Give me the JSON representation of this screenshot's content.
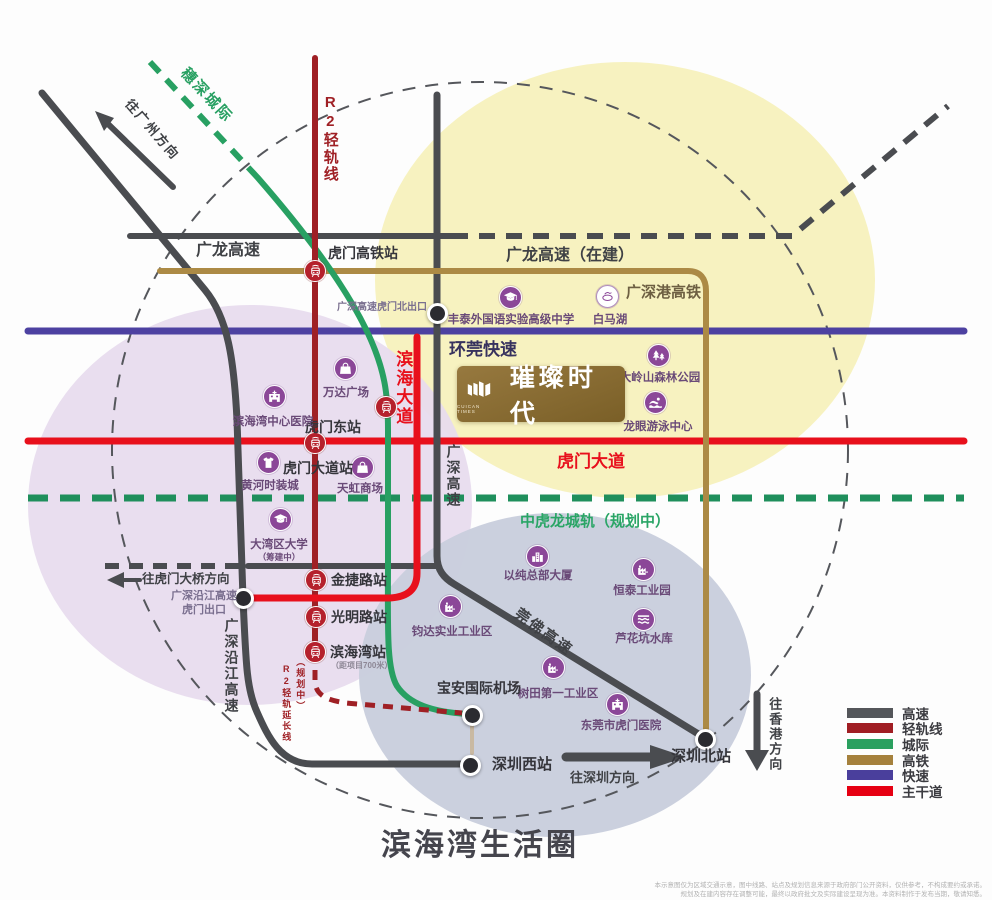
{
  "title": "滨海湾生活圈",
  "logo": {
    "name": "璀璨时代",
    "sub": "CUICAN TIMES"
  },
  "colors": {
    "gray": "#4a4c50",
    "ink": "#3f4145",
    "ink2": "#35353b",
    "red": "#e8101c",
    "red_dark": "#9f2025",
    "green": "#28a062",
    "green2": "#2aa566",
    "green_dark": "#1f8f5c",
    "brown": "#ac8a45",
    "purple": "#4d41a1",
    "tan": "#c9b9a2",
    "poi": "#8b4798",
    "station": "#b5212c",
    "poi_label": "#6a4a78",
    "node_label": "#7a6f8f",
    "sub": "#8d8795"
  },
  "zones": [
    {
      "id": "zone-yellow",
      "cx": 625,
      "cy": 280,
      "rx": 250,
      "ry": 218,
      "fill": "#f7f1bd",
      "opacity": 0.95
    },
    {
      "id": "zone-purple",
      "cx": 250,
      "cy": 505,
      "rx": 222,
      "ry": 200,
      "fill": "#e7dbee",
      "opacity": 0.93
    },
    {
      "id": "zone-blue",
      "cx": 555,
      "cy": 675,
      "rx": 196,
      "ry": 162,
      "fill": "#c9cedd",
      "opacity": 0.96
    }
  ],
  "boundary": {
    "cx": 480,
    "cy": 450,
    "r": 368,
    "color": "#55575c",
    "w": 2,
    "dash": "13 10"
  },
  "lines": [
    {
      "id": "huanguan-expressway",
      "color": "purple",
      "w": 7,
      "d": "M28 331H964"
    },
    {
      "id": "humen-avenue-road",
      "color": "red",
      "w": 7,
      "d": "M28 441H964"
    },
    {
      "id": "zhonghulong-rail",
      "color": "green_dark",
      "w": 7,
      "dash": "20 12",
      "d": "M28 498H964"
    },
    {
      "id": "guanglong-expwy",
      "color": "gray",
      "w": 6,
      "d": "M130 236H452"
    },
    {
      "id": "guanglong-expwy-uc",
      "color": "gray",
      "w": 6,
      "dash": "16 11",
      "d": "M452 236H792L948 106"
    },
    {
      "id": "yanjiang-expwy",
      "color": "gray",
      "w": 7,
      "d": "M42 93L205 290C228 318 234 360 237 420L243 598C246 668 247 690 257 712C268 737 281 764 312 764H470"
    },
    {
      "id": "humen-bridge-dashed",
      "color": "gray",
      "w": 6,
      "dash": "14 10",
      "d": "M105 566H248"
    },
    {
      "id": "humen-bridge-solid",
      "color": "gray",
      "w": 6,
      "d": "M248 566H437"
    },
    {
      "id": "guangshen-expwy",
      "color": "gray",
      "w": 7,
      "d": "M437 95V556C437 570 444 578 454 584L700 735"
    },
    {
      "id": "hsr-line",
      "color": "brown",
      "w": 6,
      "d": "M160 271H688C700 271 706 278 706 291V737"
    },
    {
      "id": "suishen-intercity-dashed",
      "color": "green",
      "w": 6,
      "dash": "14 10",
      "d": "M150 62L258 178"
    },
    {
      "id": "suishen-intercity",
      "color": "green",
      "w": 6,
      "d": "M258 178C312 240 356 300 375 350C385 376 388 396 388 430V560C388 625 386 668 397 686C409 704 432 712 468 714"
    },
    {
      "id": "r2-line",
      "color": "red_dark",
      "w": 6,
      "d": "M315 58V652"
    },
    {
      "id": "r2-extension",
      "color": "red_dark",
      "w": 5,
      "dash": "10 8",
      "d": "M315 652V680C315 695 326 700 346 703L462 713"
    },
    {
      "id": "binhai-avenue-road",
      "color": "red",
      "w": 7,
      "d": "M417 337V573C417 589 408 597 390 598H253"
    },
    {
      "id": "airport-link",
      "color": "tan",
      "w": 4,
      "d": "M472 717V753"
    },
    {
      "id": "arrow-guangzhou-shaft",
      "color": "gray",
      "w": 6,
      "d": "M173 187L106 122"
    },
    {
      "id": "arrow-humen-bridge-shaft",
      "color": "gray",
      "w": 4,
      "d": "M122 580H140"
    },
    {
      "id": "arrow-shenzhen-shaft",
      "color": "gray",
      "w": 9,
      "d": "M566 757H652"
    },
    {
      "id": "arrow-hongkong-shaft",
      "color": "gray",
      "w": 7,
      "d": "M757 694V751"
    }
  ],
  "arrow_heads": [
    {
      "id": "arrow-guangzhou-head",
      "pts": "95,111 114,118 104,131"
    },
    {
      "id": "arrow-humen-bridge-head",
      "pts": "107,580 124,572 124,588"
    },
    {
      "id": "arrow-shenzhen-head",
      "pts": "650,745 686,757 650,769"
    },
    {
      "id": "arrow-hongkong-head",
      "pts": "745,750 769,750 757,771"
    }
  ],
  "stations": [
    {
      "id": "humen-hsr-station",
      "x": 315,
      "y": 271,
      "label": "虎门高铁站",
      "lx": 328,
      "ly": 245
    },
    {
      "id": "humen-east-station",
      "x": 386,
      "y": 407,
      "label": "虎门东站",
      "lx": 305,
      "ly": 419
    },
    {
      "id": "humen-avenue-station",
      "x": 315,
      "y": 443,
      "label": "虎门大道站",
      "lx": 283,
      "ly": 460
    },
    {
      "id": "jinjie-road-station",
      "x": 316,
      "y": 580,
      "label": "金捷路站",
      "lx": 331,
      "ly": 572
    },
    {
      "id": "guangming-road-station",
      "x": 316,
      "y": 617,
      "label": "光明路站",
      "lx": 331,
      "ly": 609
    },
    {
      "id": "binhaiwan-station",
      "x": 315,
      "y": 652,
      "label": "滨海湾站",
      "lx": 330,
      "ly": 644,
      "sub": "（距项目700米）",
      "sx": 331,
      "sy": 661
    }
  ],
  "pois": [
    {
      "id": "fengtai-school",
      "x": 510,
      "y": 297,
      "icon": "cap",
      "label": "丰泰外国语实验高级中学",
      "lx": 511,
      "ly": 313
    },
    {
      "id": "baima-lake",
      "x": 607,
      "y": 296,
      "icon": "lake",
      "outline": true,
      "label": "白马湖",
      "lx": 610,
      "ly": 313
    },
    {
      "id": "dalingshan-forest-park",
      "x": 658,
      "y": 355,
      "icon": "tree",
      "label": "大岭山森林公园",
      "lx": 660,
      "ly": 371
    },
    {
      "id": "longyan-swim-center",
      "x": 655,
      "y": 402,
      "icon": "swim",
      "label": "龙眼游泳中心",
      "lx": 658,
      "ly": 420
    },
    {
      "id": "binhaiwan-hospital",
      "x": 274,
      "y": 396,
      "icon": "hospital",
      "label": "滨海湾中心医院",
      "lx": 273,
      "ly": 415
    },
    {
      "id": "wanda-plaza",
      "x": 345,
      "y": 368,
      "icon": "bag",
      "label": "万达广场",
      "lx": 346,
      "ly": 386
    },
    {
      "id": "huanghe-fashion-city",
      "x": 268,
      "y": 462,
      "icon": "clothes",
      "label": "黄河时装城",
      "lx": 270,
      "ly": 479
    },
    {
      "id": "tianhong-mall",
      "x": 362,
      "y": 467,
      "icon": "bag",
      "label": "天虹商场",
      "lx": 360,
      "ly": 482
    },
    {
      "id": "greater-bay-university",
      "x": 280,
      "y": 519,
      "icon": "cap",
      "label": "大湾区大学",
      "lx": 279,
      "ly": 538,
      "sub": "（筹建中）",
      "sx": 279,
      "sy": 552
    },
    {
      "id": "yichun-hq-tower",
      "x": 537,
      "y": 556,
      "icon": "building",
      "label": "以纯总部大厦",
      "lx": 538,
      "ly": 569
    },
    {
      "id": "hengtai-industrial-park",
      "x": 643,
      "y": 569,
      "icon": "factory",
      "label": "恒泰工业园",
      "lx": 642,
      "ly": 584
    },
    {
      "id": "luhuakeng-reservoir",
      "x": 643,
      "y": 619,
      "icon": "waves",
      "label": "芦花坑水库",
      "lx": 644,
      "ly": 632
    },
    {
      "id": "junda-industrial-zone",
      "x": 450,
      "y": 606,
      "icon": "factory",
      "label": "钧达实业工业区",
      "lx": 452,
      "ly": 625
    },
    {
      "id": "shutian-industrial-zone",
      "x": 553,
      "y": 667,
      "icon": "factory",
      "label": "树田第一工业区",
      "lx": 558,
      "ly": 687
    },
    {
      "id": "dongguan-humen-hospital",
      "x": 617,
      "y": 704,
      "icon": "hospital",
      "label": "东莞市虎门医院",
      "lx": 621,
      "ly": 719
    }
  ],
  "nodes": [
    {
      "id": "guangshen-humen-north-exit",
      "x": 437,
      "y": 313
    },
    {
      "id": "yanjiang-humen-exit",
      "x": 243,
      "y": 598
    },
    {
      "id": "baoan-airport",
      "x": 472,
      "y": 715
    },
    {
      "id": "shenzhen-west-station",
      "x": 470,
      "y": 765
    },
    {
      "id": "shenzhen-north-station",
      "x": 705,
      "y": 739
    }
  ],
  "labels": [
    {
      "id": "guanglong-label",
      "text": "广龙高速",
      "x": 196,
      "y": 241,
      "size": 16,
      "color": "ink",
      "mode": "left"
    },
    {
      "id": "guanglong-uc-label",
      "text": "广龙高速（在建）",
      "x": 506,
      "y": 246,
      "size": 16,
      "color": "ink",
      "mode": "left"
    },
    {
      "id": "r2-label",
      "text": "R2轻轨线",
      "x": 320,
      "y": 94,
      "size": 15,
      "color": "red_dark",
      "mode": "vert"
    },
    {
      "id": "suishen-label",
      "text": "穗深城际",
      "x": 206,
      "y": 96,
      "size": 15,
      "color": "green",
      "mode": "rot",
      "deg": 47
    },
    {
      "id": "gshk-hsr-label",
      "text": "广深港高铁",
      "x": 626,
      "y": 284,
      "size": 15,
      "color": "#6d5f42",
      "mode": "left"
    },
    {
      "id": "huanguan-label",
      "text": "环莞快速",
      "x": 449,
      "y": 339,
      "size": 17,
      "color": "#37325e",
      "mode": "left"
    },
    {
      "id": "humen-avenue-label",
      "text": "虎门大道",
      "x": 557,
      "y": 451,
      "size": 17,
      "color": "red",
      "mode": "left"
    },
    {
      "id": "binhai-avenue-label",
      "text": "滨海大道",
      "x": 392,
      "y": 350,
      "size": 17,
      "color": "red",
      "mode": "vert"
    },
    {
      "id": "guangshen-label",
      "text": "广深高速",
      "x": 444,
      "y": 444,
      "size": 14,
      "color": "ink",
      "mode": "vert"
    },
    {
      "id": "yanjiang-label",
      "text": "广深沿江高速",
      "x": 222,
      "y": 618,
      "size": 14,
      "color": "ink",
      "mode": "vert"
    },
    {
      "id": "wanfo-label",
      "text": "莞佛高速",
      "x": 543,
      "y": 633,
      "size": 15,
      "color": "ink",
      "mode": "rot",
      "deg": 36
    },
    {
      "id": "zhonghulong-label",
      "text": "中虎龙城轨（规划中）",
      "x": 520,
      "y": 513,
      "size": 15,
      "color": "green2",
      "mode": "left"
    },
    {
      "id": "r2-ext-label",
      "text": "R2轻轨延长线",
      "x": 280,
      "y": 664,
      "size": 9,
      "color": "red_dark",
      "mode": "vert"
    },
    {
      "id": "r2-ext-label-2",
      "text": "（规划中）",
      "x": 294,
      "y": 657,
      "size": 9,
      "color": "red_dark",
      "mode": "vert"
    },
    {
      "id": "north-exit-label",
      "text": "广深高速虎门北出口",
      "x": 427,
      "y": 302,
      "size": 10,
      "color": "node_label",
      "mode": "right"
    },
    {
      "id": "yanjiang-exit-label",
      "text": "广深沿江高速\n虎门出口",
      "x": 204,
      "y": 590,
      "size": 11,
      "color": "node_label",
      "mode": "center"
    },
    {
      "id": "baoan-airport-label",
      "text": "宝安国际机场",
      "x": 437,
      "y": 680,
      "size": 14,
      "color": "ink2",
      "mode": "left"
    },
    {
      "id": "shenzhen-west-label",
      "text": "深圳西站",
      "x": 492,
      "y": 756,
      "size": 15,
      "color": "ink2",
      "mode": "left"
    },
    {
      "id": "shenzhen-north-label",
      "text": "深圳北站",
      "x": 671,
      "y": 748,
      "size": 15,
      "color": "ink2",
      "mode": "left"
    },
    {
      "id": "to-guangzhou-label",
      "text": "往广州方向",
      "x": 152,
      "y": 130,
      "size": 13,
      "color": "ink",
      "mode": "rot",
      "deg": 49
    },
    {
      "id": "to-humen-bridge-label",
      "text": "往虎门大桥方向",
      "x": 142,
      "y": 572,
      "size": 12.5,
      "color": "ink",
      "mode": "left"
    },
    {
      "id": "to-shenzhen-label",
      "text": "往深圳方向",
      "x": 570,
      "y": 770,
      "size": 13,
      "color": "ink",
      "mode": "left"
    },
    {
      "id": "to-hongkong-label",
      "text": "往香港方向",
      "x": 766,
      "y": 697,
      "size": 13,
      "color": "ink",
      "mode": "vert"
    }
  ],
  "legend": {
    "items": [
      {
        "label": "高速",
        "color": "#54565a"
      },
      {
        "label": "轻轨线",
        "color": "#a01d23"
      },
      {
        "label": "城际",
        "color": "#2aa05f"
      },
      {
        "label": "高铁",
        "color": "#a5813d"
      },
      {
        "label": "快速",
        "color": "#4a3f9c"
      },
      {
        "label": "主干道",
        "color": "#e60012"
      }
    ]
  },
  "disclaimer": {
    "line1": "本示意图仅为区域交通示意，图中线路、站点及规划信息来源于政府部门公开资料，仅供参考，不构成要约或承诺。",
    "line2": "规划及在建内容存在调整可能，最终以政府批文及实际建设呈现为准。本资料制作于发布当期，敬请知悉。"
  }
}
